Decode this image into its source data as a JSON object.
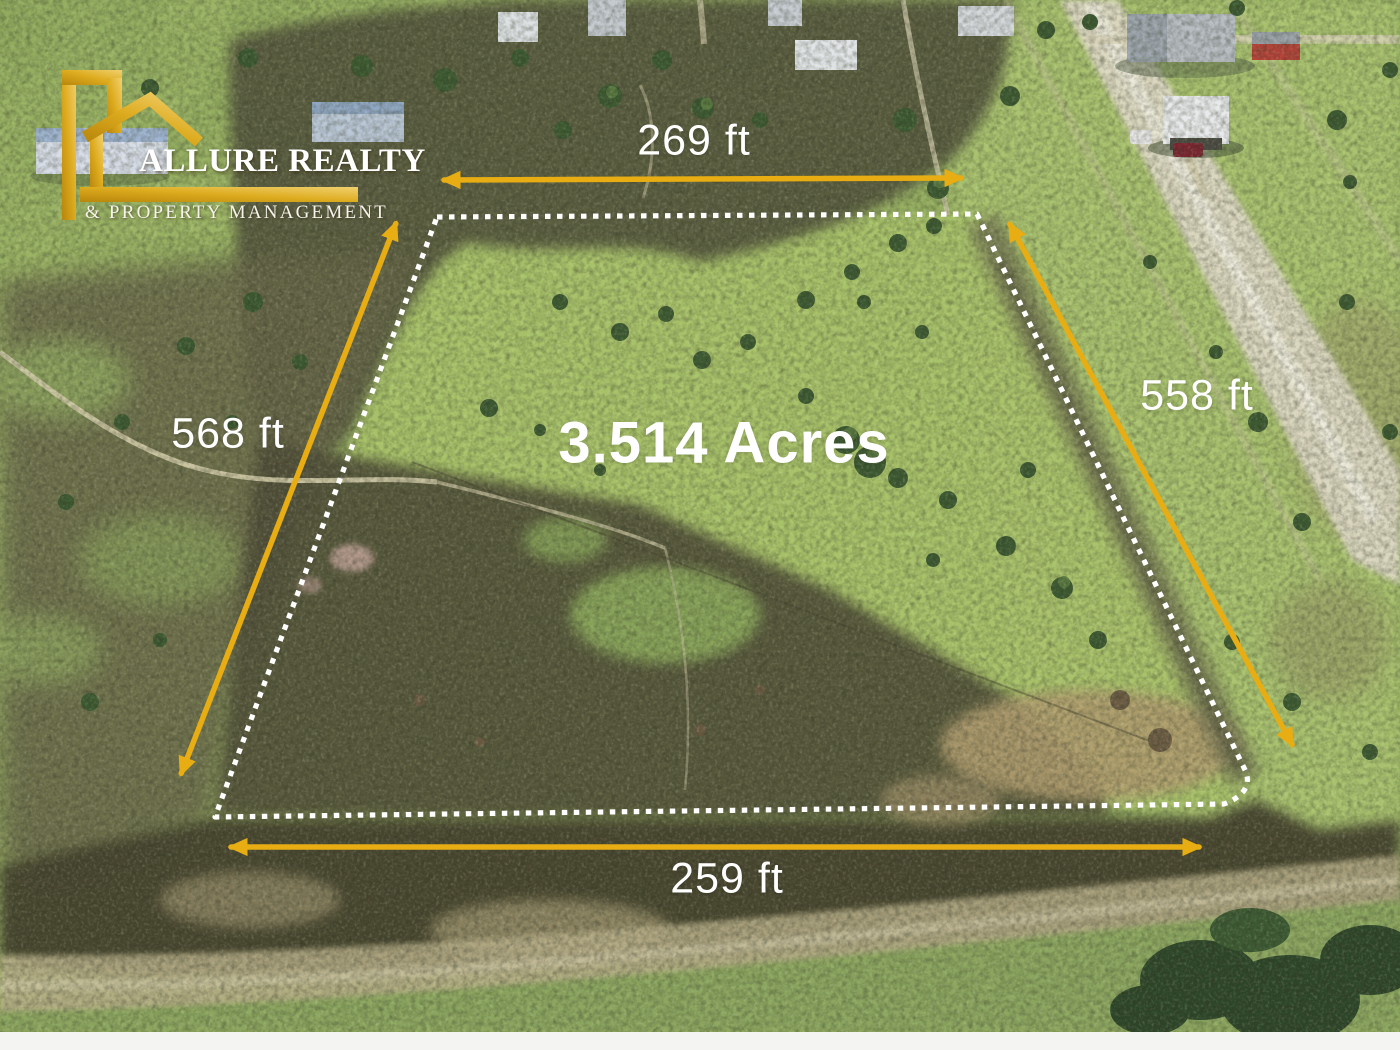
{
  "image_type": "real-estate aerial drone listing photo",
  "branding": {
    "agency_name": "ALLURE REALTY",
    "agency_tagline": "& PROPERTY MANAGEMENT",
    "logo_icon": "gold-house-outline-icon",
    "gold_dark": "#B8860B",
    "gold_light": "#F1D06E",
    "text_color": "#FFFFFF"
  },
  "parcel": {
    "area_label": "3.514 Acres",
    "boundary": {
      "style": "dotted",
      "color": "#FFFFFF"
    },
    "dimensions": {
      "top": "269 ft",
      "right": "558 ft",
      "bottom": "259 ft",
      "left": "568 ft"
    },
    "arrow_color": "#E7AD12",
    "label_color": "#FFFFFF"
  }
}
